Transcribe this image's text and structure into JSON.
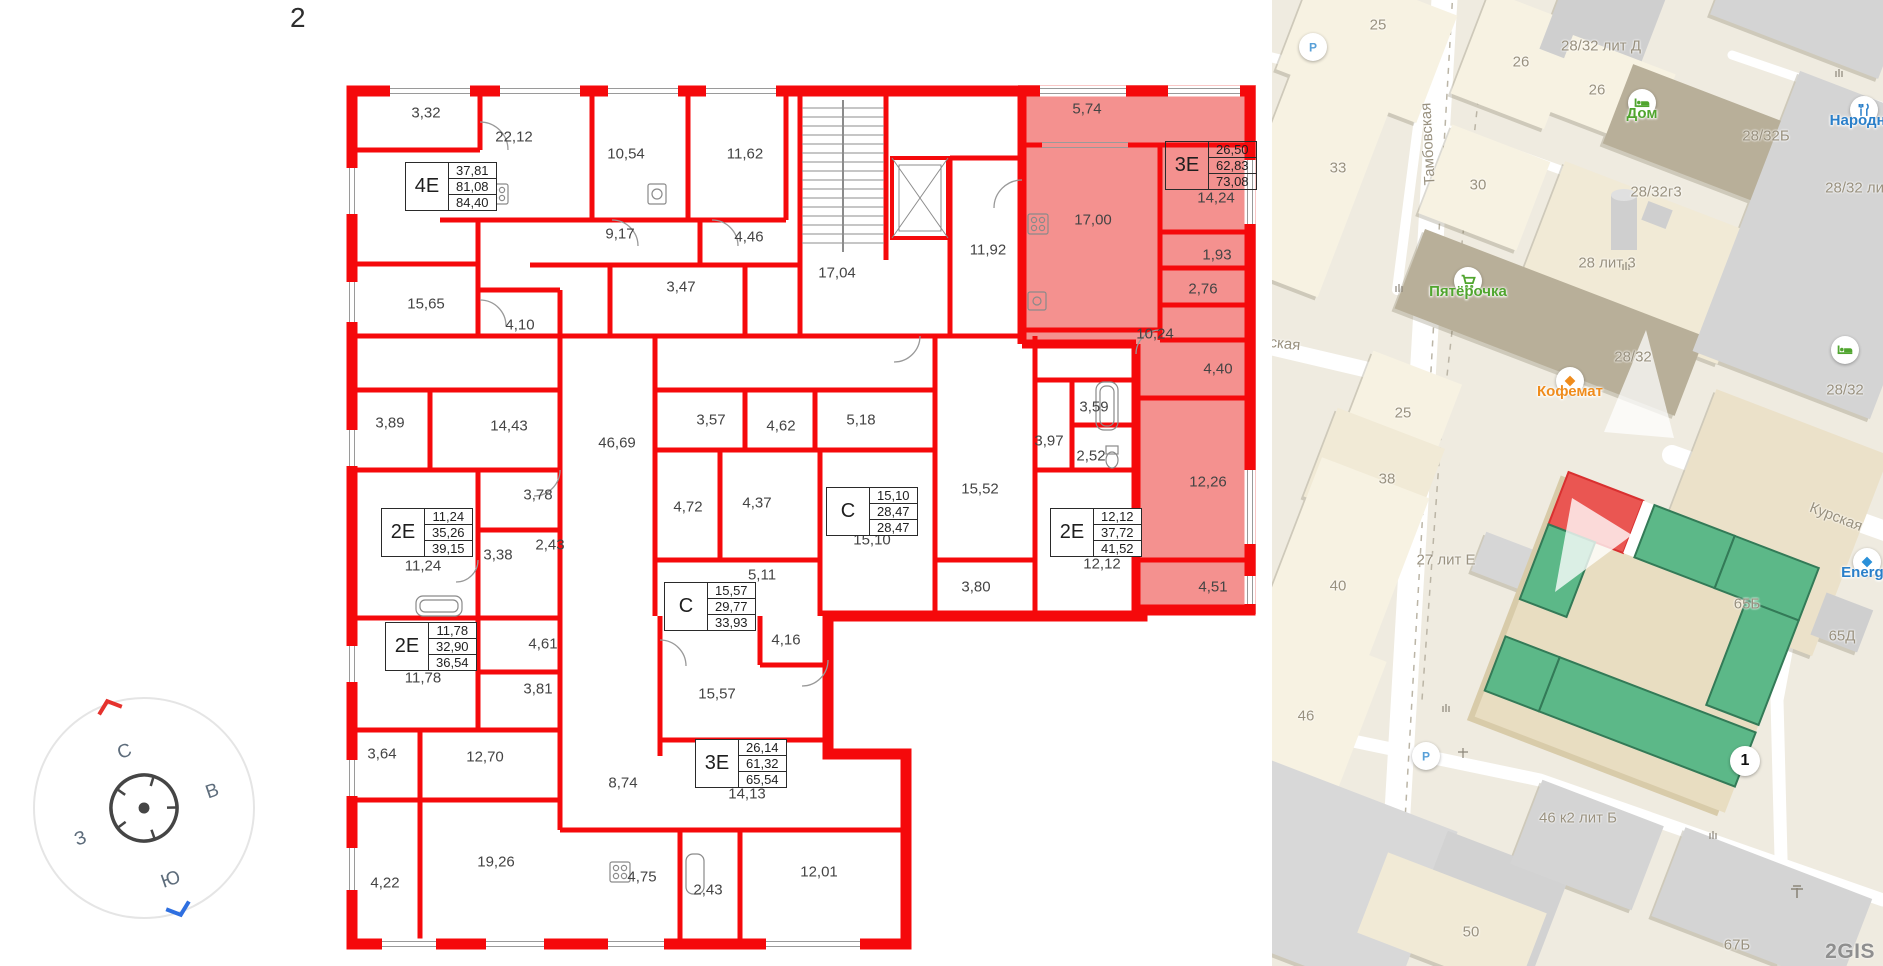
{
  "floor": {
    "label": "2"
  },
  "colors": {
    "wall_red": "#f5090b",
    "highlight_pink": "#f4918f",
    "footprint_green": "#5cb888",
    "footprint_red": "#ea5652",
    "poi_green": "#50a52f",
    "poi_orange": "#ef8c1d",
    "poi_blue": "#2a7fc9"
  },
  "compass": {
    "north": "С",
    "east": "В",
    "south": "Ю",
    "west": "З"
  },
  "plan": {
    "apartment_boxes": [
      {
        "type": "4Е",
        "areas": [
          "37,81",
          "81,08",
          "84,40"
        ],
        "x": 405,
        "y": 162,
        "highlight": false
      },
      {
        "type": "3Е",
        "areas": [
          "26,50",
          "62,83",
          "73,08"
        ],
        "x": 1165,
        "y": 141,
        "highlight": true
      },
      {
        "type": "2Е",
        "areas": [
          "11,24",
          "35,26",
          "39,15"
        ],
        "x": 381,
        "y": 508,
        "highlight": false
      },
      {
        "type": "2Е",
        "areas": [
          "11,78",
          "32,90",
          "36,54"
        ],
        "x": 385,
        "y": 622,
        "highlight": false
      },
      {
        "type": "С",
        "areas": [
          "15,10",
          "28,47",
          "28,47"
        ],
        "x": 826,
        "y": 487,
        "highlight": false
      },
      {
        "type": "С",
        "areas": [
          "15,57",
          "29,77",
          "33,93"
        ],
        "x": 664,
        "y": 582,
        "highlight": false
      },
      {
        "type": "2Е",
        "areas": [
          "12,12",
          "37,72",
          "41,52"
        ],
        "x": 1050,
        "y": 508,
        "highlight": false
      },
      {
        "type": "3Е",
        "areas": [
          "26,14",
          "61,32",
          "65,54"
        ],
        "x": 695,
        "y": 739,
        "highlight": false
      }
    ],
    "room_areas": [
      {
        "t": "3,32",
        "x": 426,
        "y": 113
      },
      {
        "t": "22,12",
        "x": 514,
        "y": 137
      },
      {
        "t": "10,54",
        "x": 626,
        "y": 154
      },
      {
        "t": "11,62",
        "x": 745,
        "y": 154
      },
      {
        "t": "9,17",
        "x": 620,
        "y": 234
      },
      {
        "t": "4,46",
        "x": 749,
        "y": 237
      },
      {
        "t": "3,47",
        "x": 681,
        "y": 287
      },
      {
        "t": "17,04",
        "x": 837,
        "y": 273
      },
      {
        "t": "11,92",
        "x": 988,
        "y": 250
      },
      {
        "t": "5,74",
        "x": 1087,
        "y": 109
      },
      {
        "t": "17,00",
        "x": 1093,
        "y": 220
      },
      {
        "t": "14,24",
        "x": 1216,
        "y": 198
      },
      {
        "t": "1,93",
        "x": 1217,
        "y": 255
      },
      {
        "t": "2,76",
        "x": 1203,
        "y": 289
      },
      {
        "t": "10,24",
        "x": 1155,
        "y": 334
      },
      {
        "t": "4,40",
        "x": 1218,
        "y": 369
      },
      {
        "t": "12,26",
        "x": 1208,
        "y": 482
      },
      {
        "t": "4,51",
        "x": 1213,
        "y": 587
      },
      {
        "t": "15,65",
        "x": 426,
        "y": 304
      },
      {
        "t": "4,10",
        "x": 520,
        "y": 325
      },
      {
        "t": "3,89",
        "x": 390,
        "y": 423
      },
      {
        "t": "14,43",
        "x": 509,
        "y": 426
      },
      {
        "t": "46,69",
        "x": 617,
        "y": 443
      },
      {
        "t": "3,78",
        "x": 538,
        "y": 495
      },
      {
        "t": "3,57",
        "x": 711,
        "y": 420
      },
      {
        "t": "4,62",
        "x": 781,
        "y": 426
      },
      {
        "t": "5,18",
        "x": 861,
        "y": 420
      },
      {
        "t": "4,72",
        "x": 688,
        "y": 507
      },
      {
        "t": "4,37",
        "x": 757,
        "y": 503
      },
      {
        "t": "3,38",
        "x": 498,
        "y": 555
      },
      {
        "t": "2,43",
        "x": 550,
        "y": 545
      },
      {
        "t": "11,24",
        "x": 423,
        "y": 566
      },
      {
        "t": "5,11",
        "x": 762,
        "y": 575
      },
      {
        "t": "15,52",
        "x": 980,
        "y": 489
      },
      {
        "t": "3,59",
        "x": 1094,
        "y": 407
      },
      {
        "t": "3,97",
        "x": 1049,
        "y": 441
      },
      {
        "t": "2,52",
        "x": 1091,
        "y": 456
      },
      {
        "t": "3,80",
        "x": 976,
        "y": 587
      },
      {
        "t": "12,12",
        "x": 1102,
        "y": 564
      },
      {
        "t": "15,10",
        "x": 872,
        "y": 540
      },
      {
        "t": "4,61",
        "x": 543,
        "y": 644
      },
      {
        "t": "11,78",
        "x": 423,
        "y": 678
      },
      {
        "t": "3,81",
        "x": 538,
        "y": 689
      },
      {
        "t": "15,57",
        "x": 717,
        "y": 694
      },
      {
        "t": "4,16",
        "x": 786,
        "y": 640
      },
      {
        "t": "8,74",
        "x": 623,
        "y": 783
      },
      {
        "t": "14,13",
        "x": 747,
        "y": 794
      },
      {
        "t": "3,64",
        "x": 382,
        "y": 754
      },
      {
        "t": "12,70",
        "x": 485,
        "y": 757
      },
      {
        "t": "19,26",
        "x": 496,
        "y": 862
      },
      {
        "t": "4,22",
        "x": 385,
        "y": 883
      },
      {
        "t": "4,75",
        "x": 642,
        "y": 877
      },
      {
        "t": "2,43",
        "x": 708,
        "y": 890
      },
      {
        "t": "12,01",
        "x": 819,
        "y": 872
      }
    ]
  },
  "map": {
    "watermark": "2GIS",
    "entrance_badge": "1",
    "labels": [
      {
        "t": "25",
        "x": 106,
        "y": 25
      },
      {
        "t": "26",
        "x": 249,
        "y": 62
      },
      {
        "t": "28/32 лит Д",
        "x": 329,
        "y": 46
      },
      {
        "t": "26",
        "x": 325,
        "y": 90
      },
      {
        "t": "28/32Б",
        "x": 494,
        "y": 136
      },
      {
        "t": "33",
        "x": 66,
        "y": 168
      },
      {
        "t": "30",
        "x": 206,
        "y": 185
      },
      {
        "t": "28/32г3",
        "x": 384,
        "y": 192
      },
      {
        "t": "28/32 лит",
        "x": 586,
        "y": 188
      },
      {
        "t": "Тамбовская",
        "x": 156,
        "y": 144,
        "rot": -93
      },
      {
        "t": "28 лит 3",
        "x": 335,
        "y": 263
      },
      {
        "t": "28/32",
        "x": 361,
        "y": 357
      },
      {
        "t": "25",
        "x": 131,
        "y": 413
      },
      {
        "t": "ская",
        "x": 13,
        "y": 344,
        "rot": 6
      },
      {
        "t": "38",
        "x": 115,
        "y": 479
      },
      {
        "t": "28/32",
        "x": 573,
        "y": 390
      },
      {
        "t": "Курская",
        "x": 564,
        "y": 517,
        "rot": 21
      },
      {
        "t": "27 лит Е",
        "x": 174,
        "y": 560
      },
      {
        "t": "65Б",
        "x": 475,
        "y": 604
      },
      {
        "t": "40",
        "x": 66,
        "y": 586
      },
      {
        "t": "65Д",
        "x": 570,
        "y": 636
      },
      {
        "t": "46",
        "x": 34,
        "y": 716
      },
      {
        "t": "46 к2 лит Б",
        "x": 306,
        "y": 818
      },
      {
        "t": "50",
        "x": 199,
        "y": 932
      },
      {
        "t": "67Б",
        "x": 465,
        "y": 945
      }
    ],
    "pois": [
      {
        "id": "pyaterochka",
        "label": "Пятёрочка",
        "icon": "cart-icon",
        "color": "#50a52f",
        "x": 196,
        "y": 281
      },
      {
        "id": "kofemat",
        "label": "Кофемат",
        "icon": "diamond-icon",
        "color": "#ef8c1d",
        "x": 298,
        "y": 381
      },
      {
        "id": "dom",
        "label": "Дом",
        "icon": "bed-icon",
        "color": "#50a52f",
        "x": 370,
        "y": 103
      },
      {
        "id": "narodny",
        "label": "Народны",
        "icon": "utensils-icon",
        "color": "#2a7fc9",
        "x": 592,
        "y": 110
      },
      {
        "id": "energo",
        "label": "Energo",
        "icon": "gem-icon",
        "color": "#2a7fc9",
        "x": 595,
        "y": 562
      },
      {
        "id": "hotel",
        "label": "",
        "icon": "bed-icon",
        "color": "#50a52f",
        "x": 573,
        "y": 350
      },
      {
        "id": "parking-north",
        "label": "",
        "icon": "parking-icon",
        "color": "#58a0d8",
        "x": 41,
        "y": 47
      },
      {
        "id": "parking-south",
        "label": "",
        "icon": "parking-icon",
        "color": "#58a0d8",
        "x": 154,
        "y": 756
      }
    ]
  }
}
